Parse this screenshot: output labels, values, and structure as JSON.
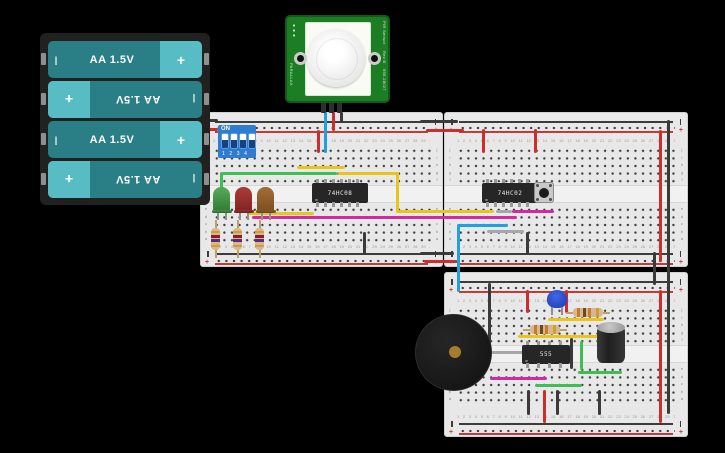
{
  "battery_pack": {
    "cell_label": "AA 1.5V",
    "plus_symbol": "+",
    "minus_symbol": "|"
  },
  "pir_sensor": {
    "name_line1": "PIR Sensor",
    "name_line2": "Rev B",
    "part_number": "555-28027",
    "brand": "PARALLAX"
  },
  "dip_switch": {
    "on_label": "ON",
    "position_labels": "1 2 3 4"
  },
  "chips": {
    "and_gate": "74HC08",
    "nor_gate": "74HC02",
    "timer": "555"
  },
  "breadboard": {
    "column_numbers": "1 2 3 4 5 6 7 8 9 10 11 12 13 14 15 16 17 18 19 20 21 22 23 24 25 26 27 28 29 30",
    "row_letters_top": "j\ni\nh\ng\nf",
    "row_letters_bottom": "e\nd\nc\nb\na",
    "positive_symbol": "+"
  },
  "colors": {
    "wire_red": "#c92f2f",
    "wire_black": "#3a3a3a",
    "wire_blue": "#1fa1da",
    "wire_yellow": "#e9c51c",
    "wire_green": "#3fbf52",
    "wire_magenta": "#d22ba0",
    "wire_gray": "#a4a8ab",
    "breadboard_body": "#e8e8e8",
    "rail_red": "#c43a3a",
    "rail_black": "#3c3c3c",
    "battery_body": "#2a7f86",
    "battery_cap": "#57bcc3",
    "battery_holder": "#212121",
    "pir_board": "#1b7e22",
    "dip_blue": "#2e7dd1",
    "led_green": "#3a8a3d",
    "led_red": "#9c3030",
    "led_orange": "#92602a",
    "ic_body": "#262626",
    "buzzer": "#1d1d1d",
    "buzzer_center": "#a57d2a",
    "capacitor_blue": "#2b50d0",
    "capacitor_electrolytic": "#2b2b2b",
    "resistor_body": "#d7b690"
  }
}
